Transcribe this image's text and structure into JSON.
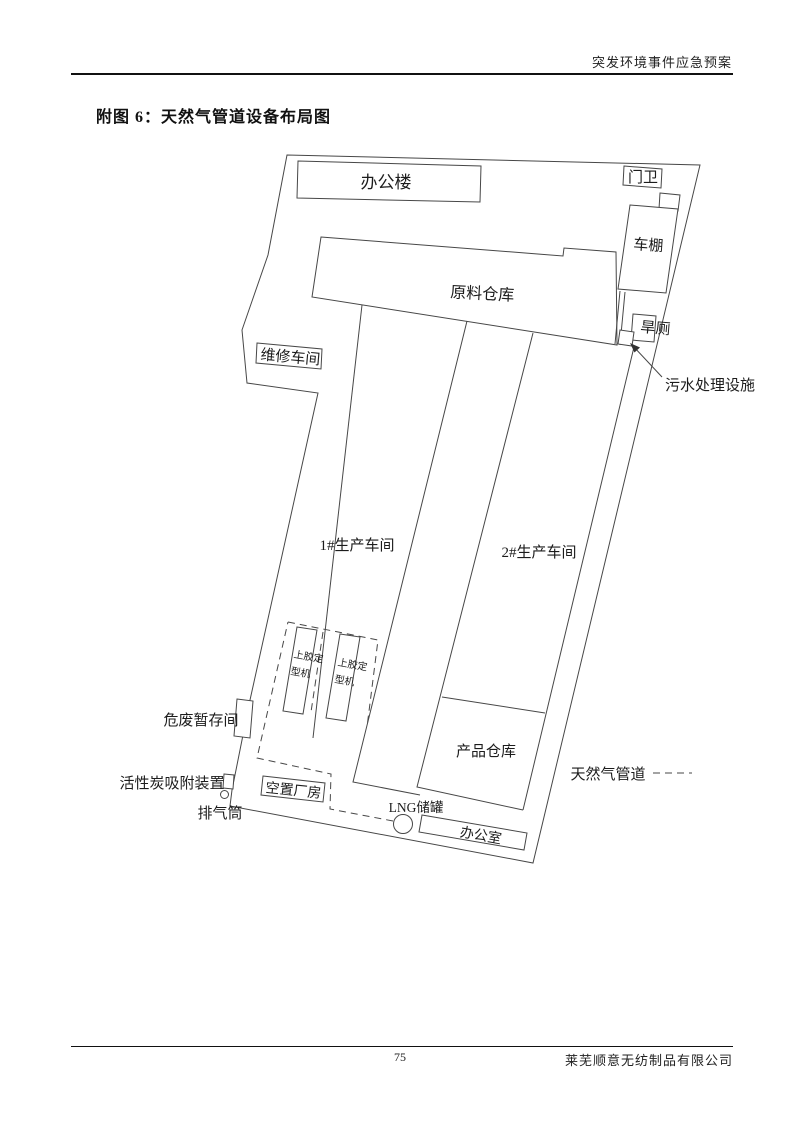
{
  "page": {
    "header": "突发环境事件应急预案",
    "title": "附图 6：天然气管道设备布局图",
    "footer": {
      "page_number": "75",
      "company": "莱芜顺意无纺制品有限公司"
    }
  },
  "diagram": {
    "line_color": "#474747",
    "labels": {
      "office_building": "办公楼",
      "gate_guard": "门卫",
      "carport": "车棚",
      "raw_material_warehouse": "原料仓库",
      "maintenance_workshop": "维修车间",
      "dry_toilet": "旱厕",
      "sewage_treatment_facility": "污水处理设施",
      "workshop_1": "1#生产车间",
      "workshop_2": "2#生产车间",
      "gluing_machine_line1": "上胶定",
      "gluing_machine_line2": "型机",
      "hazardous_waste_room": "危废暂存间",
      "product_warehouse": "产品仓库",
      "activated_carbon_device": "活性炭吸附装置",
      "vacant_building": "空置厂房",
      "exhaust_stack": "排气筒",
      "lng_tank": "LNG储罐",
      "office_room": "办公室",
      "pipeline_legend": "天然气管道"
    }
  }
}
